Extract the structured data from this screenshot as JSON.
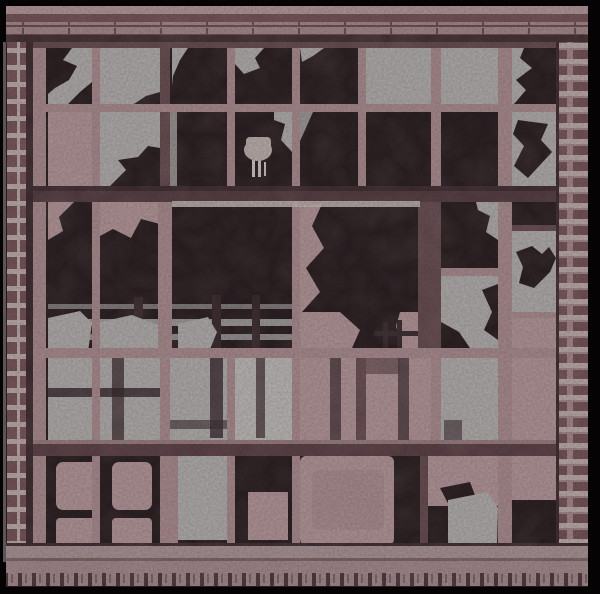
{
  "scene": {
    "title": "Broken windows of an abandoned factory — posterized photograph",
    "subject": "derelict industrial window wall, grid of panes with many shattered black voids, set in a brick facade",
    "visible_elements": [
      "brick lintel courses across the top",
      "small square bricks down the left edge",
      "striped brick courses down the right edge",
      "steel window grid with dusty gray-pink mullions",
      "intact dusty glass panes (gray with pink grime)",
      "black voids where panes are broken, with jagged glass shards",
      "horizontal interior railing bars visible through the missing center panes",
      "small pale brush-like object standing on an inner sill",
      "lower sash of grimy pink panes",
      "small 2x2 pink pane grid at lower left",
      "stone ledge and dentil brick course along the bottom",
      "solid black photo border"
    ],
    "style": "high-contrast posterized duotone (black / dusty rose / gray)"
  },
  "palette": {
    "frameBlack": "#050304",
    "voidBlack": "#0b0607",
    "brickLight": "#a89092",
    "brickDark": "#5f4245",
    "brickMid": "#977f80",
    "mortarLight": "#b4a8a7",
    "brickRed": "#6f5255",
    "mullionPink": "#9d8385",
    "mullionDark": "#503a3d",
    "transomDark": "#3c2a2d",
    "glassGray": "#a6aba8",
    "glassPink": "#a88f91",
    "glassBright": "#b5b9b6",
    "barGray": "#8f9391",
    "highlight": "#bcb6b2",
    "ledge": "#9c8c8d",
    "dentil": "#968184"
  }
}
